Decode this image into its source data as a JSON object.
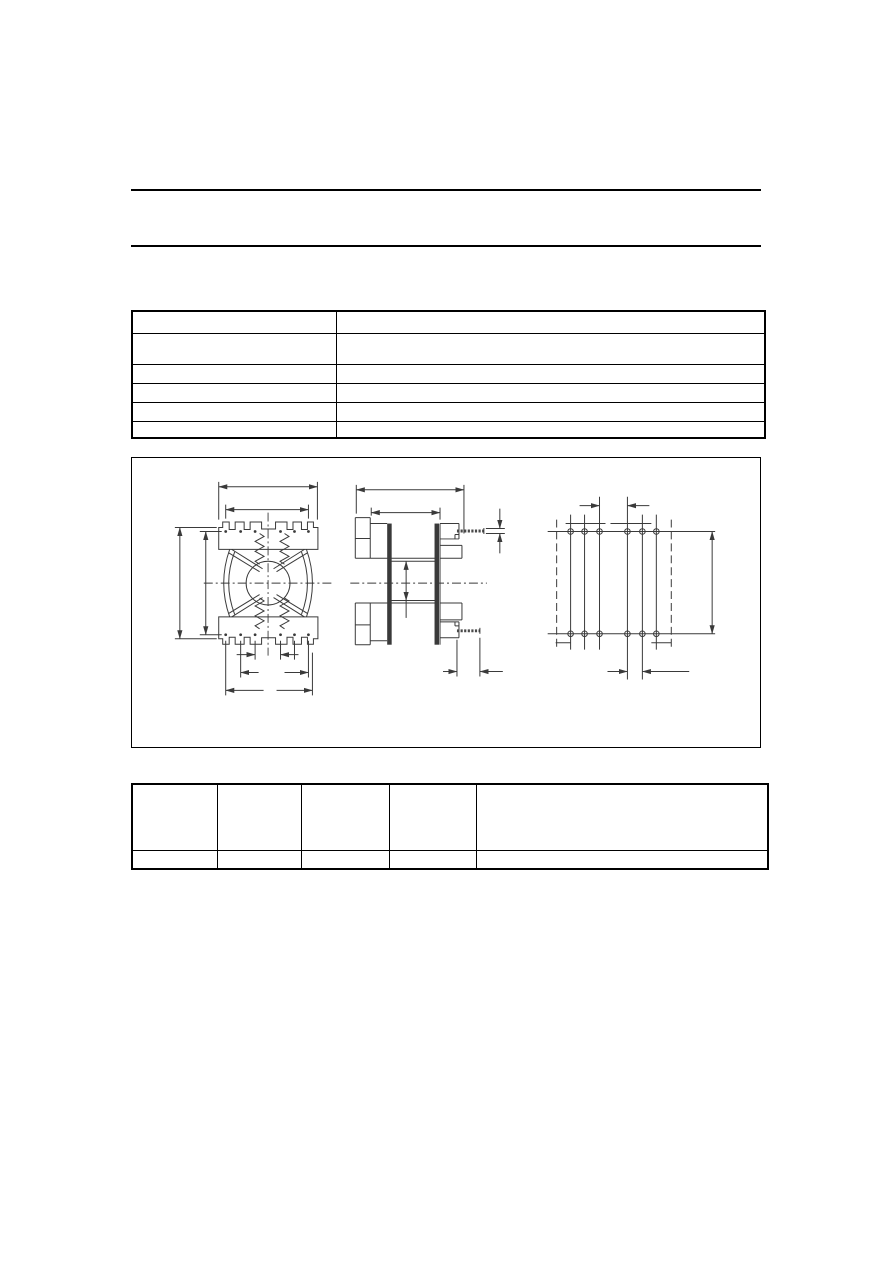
{
  "page": {
    "background": "#ffffff",
    "note": "Technical datasheet page; vector line art only, no text glyphs rendered"
  },
  "colors": {
    "rule": "#000000",
    "table_border": "#000000",
    "drawing_stroke": "#3a3a3a"
  },
  "header": {
    "title_text": "",
    "subtitle_text": ""
  },
  "spec_table": {
    "rows": 6,
    "columns": 2,
    "row_heights": [
      22,
      31,
      19,
      19,
      19,
      17
    ],
    "col_widths": [
      203,
      427
    ],
    "cells": [
      [
        "",
        ""
      ],
      [
        "",
        ""
      ],
      [
        "",
        ""
      ],
      [
        "",
        ""
      ],
      [
        "",
        ""
      ],
      [
        "",
        ""
      ]
    ]
  },
  "figure": {
    "kind": "engineering-dimension-drawing",
    "subject": "coil former (bobbin) shown in three orthographic views with dimension arrows",
    "views": [
      {
        "name": "front-view",
        "features": "castellated flanges, center circle, coil springs, centerlines, 4 width/height dimensions, 3 levels of pin-pitch dimensions"
      },
      {
        "name": "side-view",
        "features": "two flanges with solder pins top-right and bottom-right, winding window height dimension, pin length dimension"
      },
      {
        "name": "bottom-view",
        "features": "2 rows x 6 solder pins, dashed body outline, pin pitch and row spacing dimensions"
      }
    ],
    "pin_rows": 2,
    "pins_per_row": 6
  },
  "dims_table": {
    "rows": 2,
    "columns": 5,
    "row_heights": [
      66,
      19
    ],
    "col_widths": [
      84,
      83,
      87,
      86,
      290
    ],
    "cells": [
      [
        "",
        "",
        "",
        "",
        ""
      ],
      [
        "",
        "",
        "",
        "",
        ""
      ]
    ]
  }
}
